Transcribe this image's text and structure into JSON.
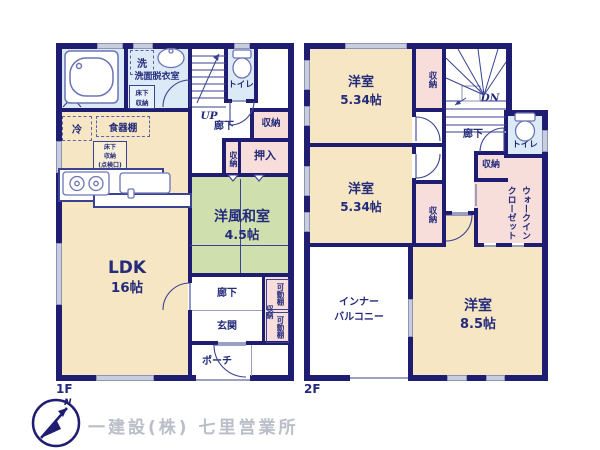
{
  "colors": {
    "wall": "#1e1d72",
    "text": "#232b7a",
    "room_cream": "#f6e6c4",
    "room_green": "#cfe0ae",
    "room_blue": "#dce9f6",
    "room_pink": "#f8dedb",
    "window_fill": "#c9cede",
    "company_text": "#b9bec8"
  },
  "f1": {
    "floor_label": "1F",
    "ub": "UB",
    "laundry": "洗",
    "washroom": "洗面脱衣室",
    "underfloor_storage": "床下\n収納",
    "toilet": "トイレ",
    "stairs_up": "UP",
    "hallway_upper": "廊下",
    "hall_closet": "収納",
    "fridge": "冷",
    "cupboard": "食器棚",
    "underfloor_hatch": "床下\n収納\n(点検口)",
    "closet_small": "収納",
    "oshiire": "押入",
    "washitsu_name": "洋風和室",
    "washitsu_size": "4.5帖",
    "ldk_name": "LDK",
    "ldk_size": "16帖",
    "hallway_lower": "廊下",
    "entrance": "玄関",
    "shelf_upper": "可動棚",
    "entrance_closet": "収納",
    "shelf_lower": "可動棚",
    "porch": "ポーチ"
  },
  "f2": {
    "floor_label": "2F",
    "room1_name": "洋室",
    "room1_size": "5.34帖",
    "closet1": "収納",
    "stairs_down": "DN",
    "hallway": "廊下",
    "toilet": "トイレ",
    "closet2": "収納",
    "wic": "ウォークイン\nクローゼット",
    "room2_name": "洋室",
    "room2_size": "5.34帖",
    "closet3": "収納",
    "balcony": "インナー\nバルコニー",
    "room3_name": "洋室",
    "room3_size": "8.5帖"
  },
  "footer": {
    "company": "一建設(株) 七里営業所",
    "north": "N"
  }
}
